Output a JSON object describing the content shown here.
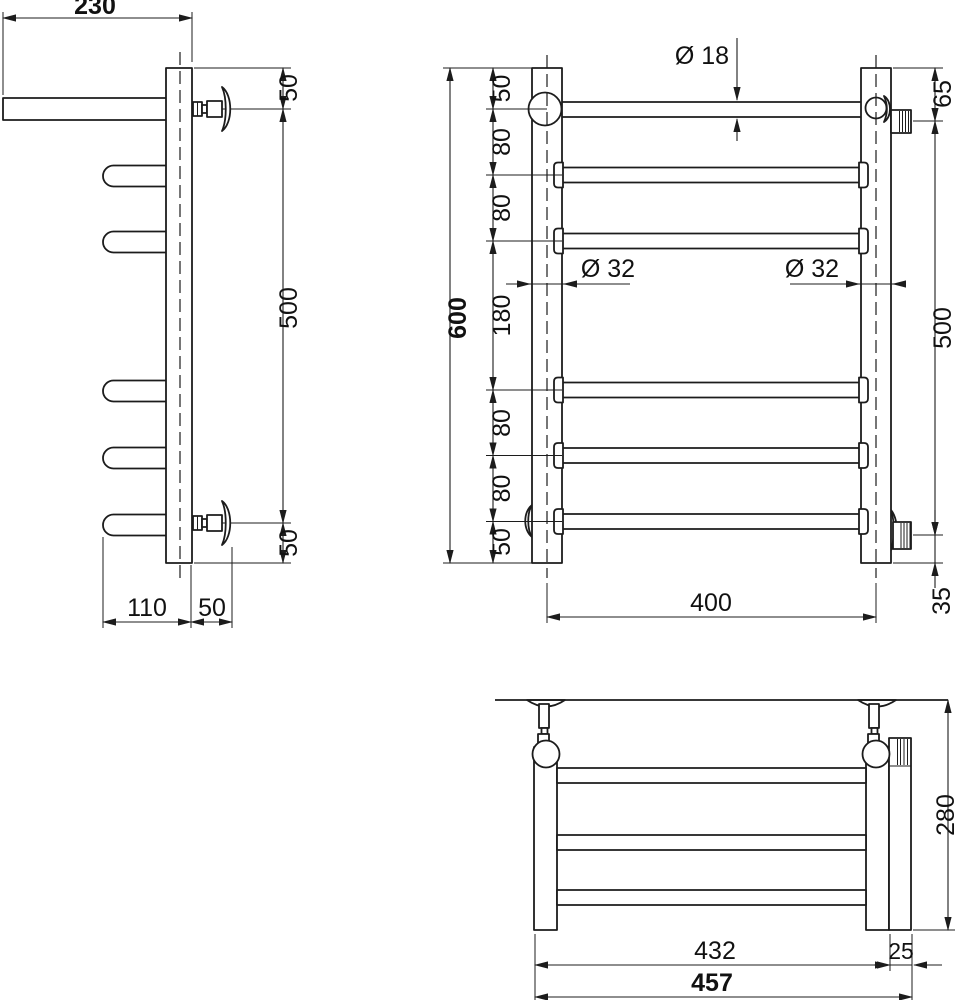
{
  "drawing": {
    "colors": {
      "line": "#1c1c1c",
      "background": "#ffffff"
    },
    "side": {
      "shelf_depth": "230",
      "top_offset": "50",
      "bracket_span": "500",
      "bottom_offset": "50",
      "rung_depth": "110",
      "bracket_depth": "50"
    },
    "front": {
      "total_height": "600",
      "seg_top": "50",
      "seg_2": "80",
      "seg_3": "80",
      "seg_mid": "180",
      "seg_5": "80",
      "seg_6": "80",
      "seg_bottom": "50",
      "rail_span": "400",
      "fitting_top": "65",
      "fitting_span": "500",
      "fitting_bottom": "35",
      "rung_diameter": "Ø 18",
      "post_diameter_left": "Ø 32",
      "post_diameter_right": "Ø 32"
    },
    "top": {
      "depth": "280",
      "body_width": "432",
      "element_width": "25",
      "total_width": "457"
    }
  }
}
